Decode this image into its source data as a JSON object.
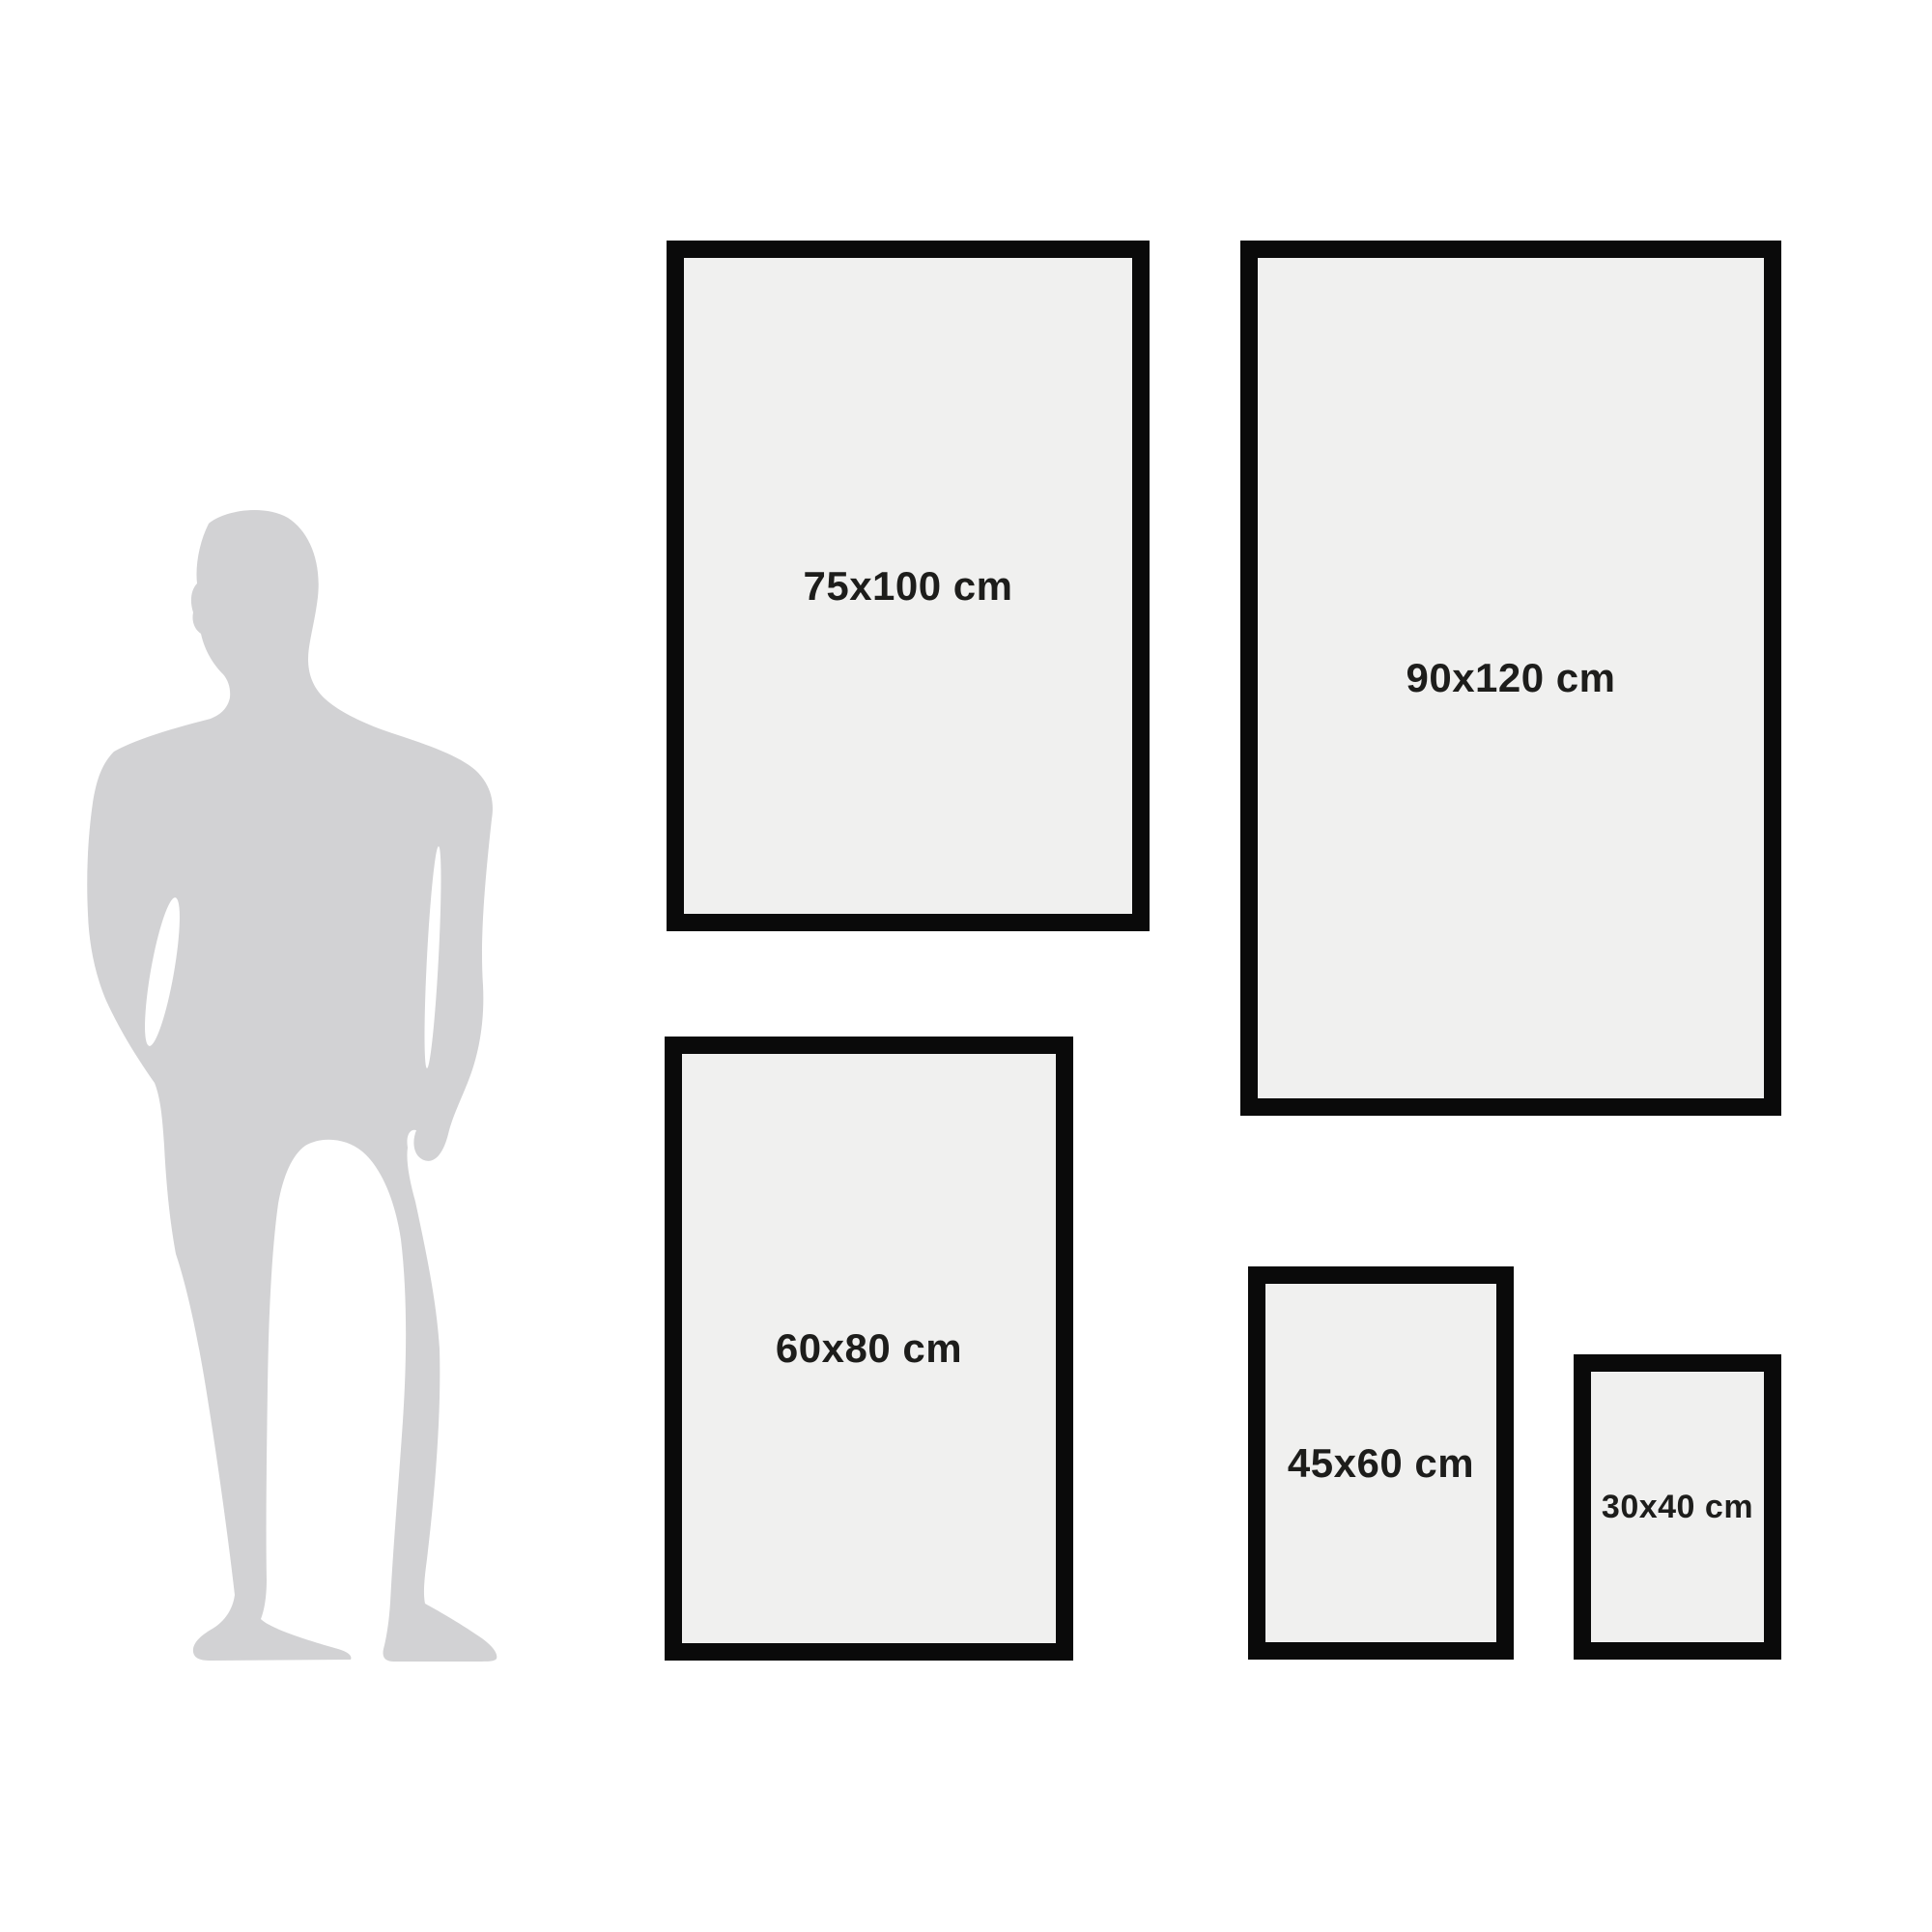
{
  "size_guide": {
    "unit": "cm",
    "silhouette": {
      "name": "man-silhouette",
      "color": "#d2d2d4"
    },
    "colors": {
      "background": "#ffffff",
      "frame_border": "#0a0a0a",
      "frame_fill": "#f0f0ef",
      "label_text": "#1d1d1b"
    },
    "frames": [
      {
        "label": "75x100 cm"
      },
      {
        "label": "90x120 cm"
      },
      {
        "label": "60x80 cm"
      },
      {
        "label": "45x60 cm"
      },
      {
        "label": "30x40 cm"
      }
    ]
  }
}
